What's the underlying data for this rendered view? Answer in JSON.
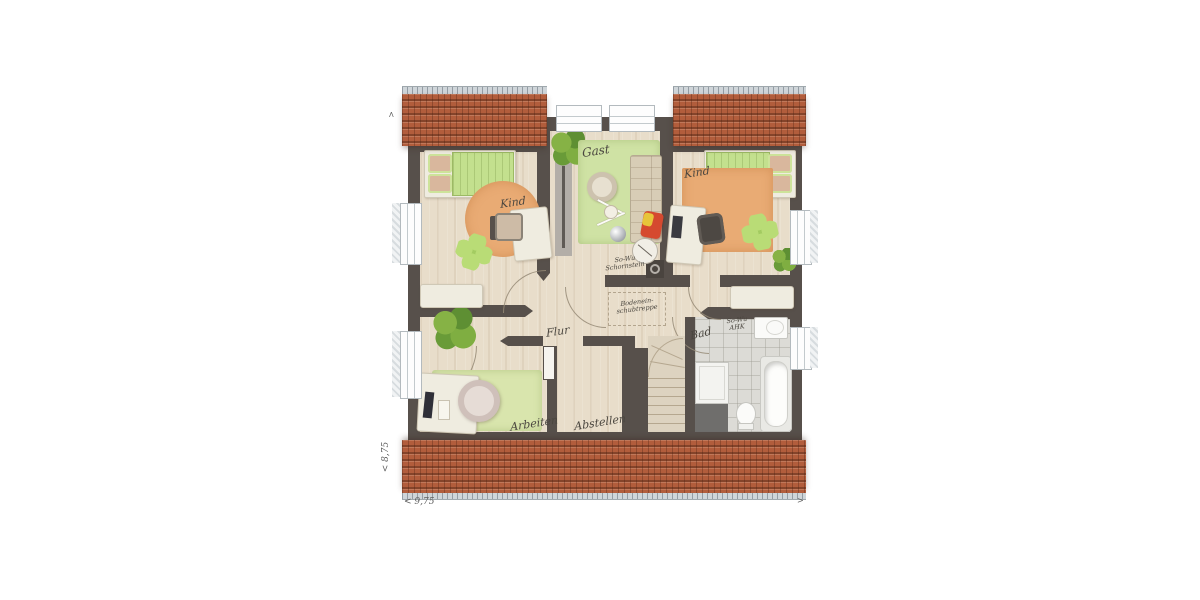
{
  "labels": {
    "room_kind_left": "Kind",
    "room_gast": "Gast",
    "room_kind_right": "Kind",
    "room_flur": "Flur",
    "room_bad": "Bad",
    "room_arbeiten": "Arbeiten",
    "room_abstellen": "Abstellen",
    "chimney_line1": "So-Wu",
    "chimney_line2": "Schornstein",
    "ladder_line1": "Bodenein-",
    "ladder_line2": "schubtreppe",
    "bath_line1": "So-Wu",
    "bath_line2": "AHK",
    "dim_bottom": "< 9,75",
    "dim_left": "< 8,75",
    "marker_top": ">",
    "marker_right": ">"
  },
  "colors": {
    "roof": "#b25d3c",
    "gutter": "#cfd5d9",
    "wall": "#57504b",
    "wood_floor": "#e8ddca",
    "bath_floor": "#dcdbd6",
    "rug_green": "#cfe2a4",
    "rug_orange": "#e9ab74",
    "bed_green": "#c3e08e",
    "furniture": "#efece0"
  }
}
